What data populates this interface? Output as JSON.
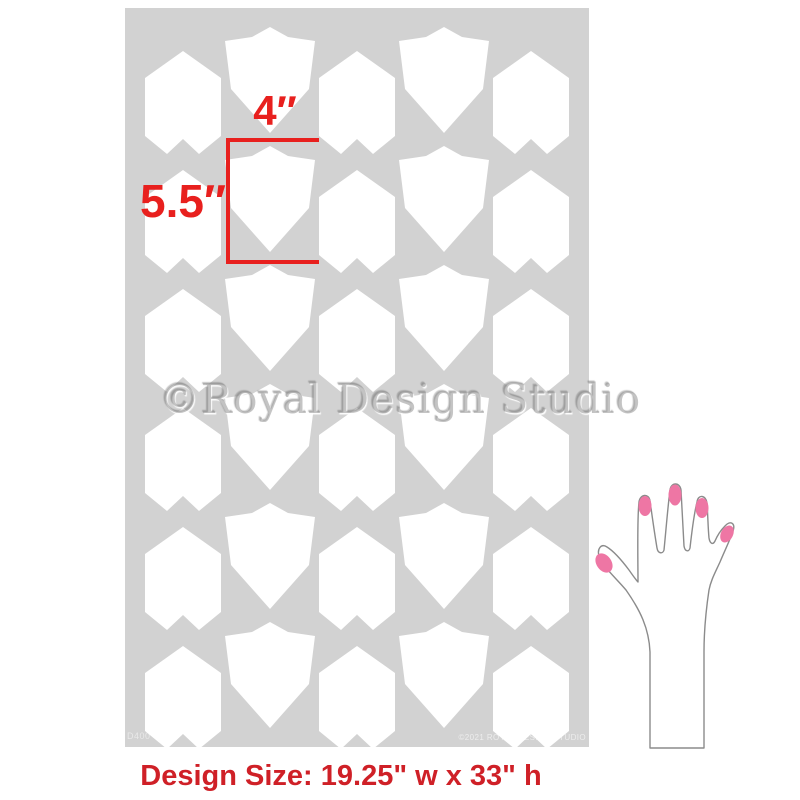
{
  "stencil": {
    "sheet_color": "#d2d2d2",
    "shape_color": "#ffffff",
    "sku_code": "D400",
    "copyright_small": "©2021 ROYAL DESIGN STUDIO",
    "pattern": {
      "rows": 6,
      "row_pitch": 119,
      "columns": [
        {
          "type": "arrow",
          "cx": 58
        },
        {
          "type": "shield",
          "cx": 145
        },
        {
          "type": "arrow",
          "cx": 232
        },
        {
          "type": "shield",
          "cx": 319
        },
        {
          "type": "arrow",
          "cx": 406
        }
      ],
      "shapes": {
        "arrow": {
          "w": 76,
          "h": 103,
          "y0": 43,
          "points": "38,0 0,27 0,85 22,103 38,88 54,103 76,85 76,27"
        },
        "shield": {
          "w": 90,
          "h": 106,
          "y0": 19,
          "points": "45,0 63,10 90,14 84,62 45,106 6,62 0,14 27,10"
        }
      }
    }
  },
  "annotations": {
    "width_label": "4″",
    "height_label": "5.5″",
    "color": "#e8201e"
  },
  "watermark": {
    "text": "©Royal Design Studio"
  },
  "hand": {
    "nail_color": "#ee76a4",
    "outline_color": "#8b8b8b"
  },
  "footer": {
    "design_size_label": "Design Size: 19.25\" w x 33\" h",
    "color": "#cf2027"
  }
}
